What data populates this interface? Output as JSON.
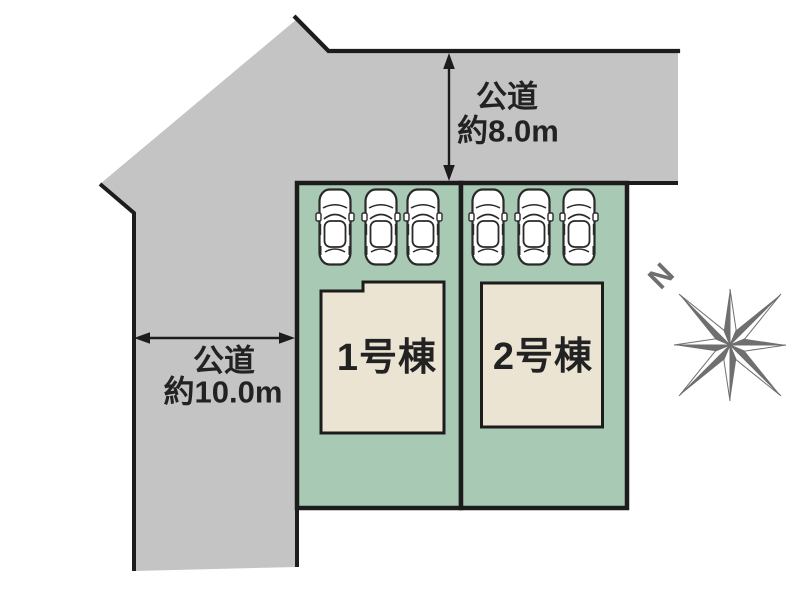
{
  "annotations": {
    "top_road": {
      "line1": "公道",
      "line2": "約8.0m"
    },
    "left_road": {
      "line1": "公道",
      "line2": "約10.0m"
    }
  },
  "lots": [
    {
      "label": "1号棟"
    },
    {
      "label": "2号棟"
    }
  ],
  "compass": {
    "label": "N"
  },
  "colors": {
    "road": "#c4c4c4",
    "lot_green": "#a8cab5",
    "building_beige": "#ebe4d3",
    "outline_black": "#1c1c1c",
    "text_black": "#222222",
    "compass_gray": "#6f6f6f",
    "car_white": "#ffffff",
    "background": "#ffffff"
  }
}
